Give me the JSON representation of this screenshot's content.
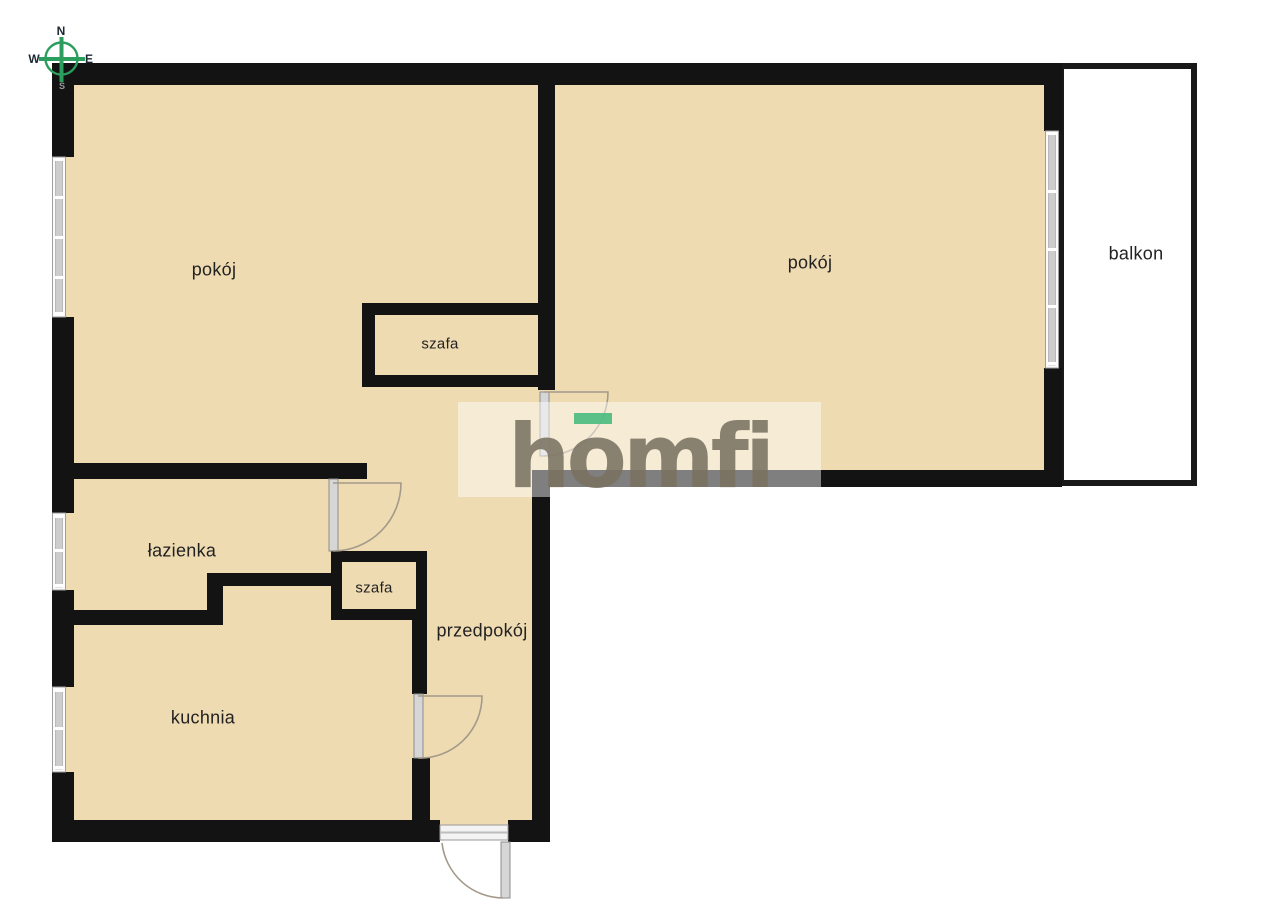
{
  "page": {
    "background": "#ffffff"
  },
  "floorplan": {
    "wall_color": "#131313",
    "room_fill": "#efdbb2",
    "balcony_fill": "#ffffff",
    "rooms": [
      {
        "id": "pokoj-left",
        "label": "pokój"
      },
      {
        "id": "pokoj-right",
        "label": "pokój"
      },
      {
        "id": "szafa-top",
        "label": "szafa"
      },
      {
        "id": "lazienka",
        "label": "łazienka"
      },
      {
        "id": "szafa-small",
        "label": "szafa"
      },
      {
        "id": "przedpokoj",
        "label": "przedpokój"
      },
      {
        "id": "kuchnia",
        "label": "kuchnia"
      },
      {
        "id": "balkon",
        "label": "balkon"
      }
    ]
  },
  "compass": {
    "north": "N",
    "east": "E",
    "south": "S",
    "west": "W",
    "accent_color": "#2b9d5c"
  },
  "watermark": {
    "text": "homfi",
    "accent_color": "#4cbc81",
    "text_color": "#7a7261"
  }
}
